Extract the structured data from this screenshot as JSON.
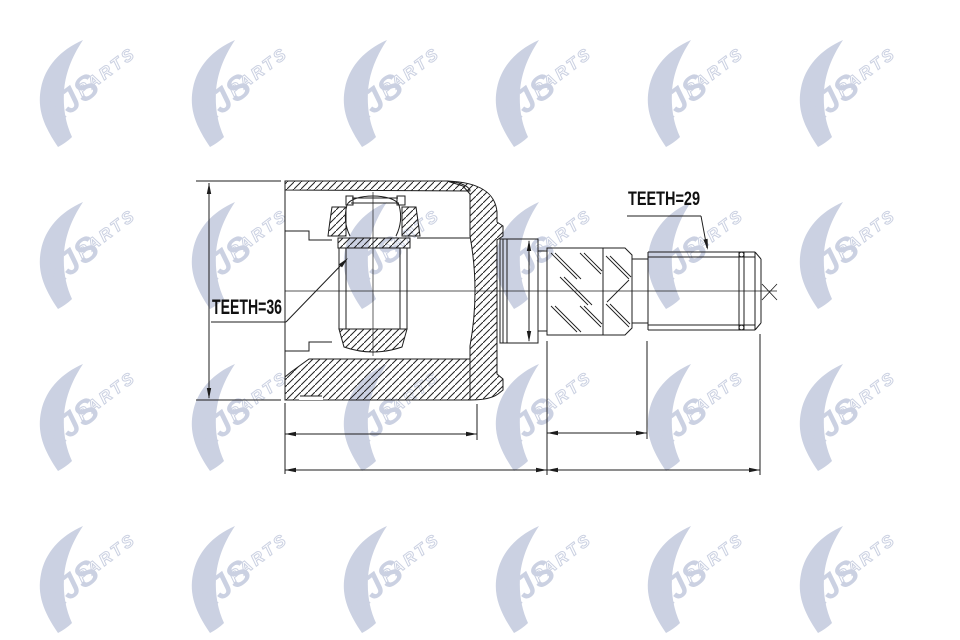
{
  "watermark": {
    "brand": "AJS",
    "suffix": "PARTS",
    "color": "#cbd1e2"
  },
  "drawing": {
    "labels": {
      "teeth_inner": "TEETH=36",
      "teeth_outer": "TEETH=29"
    },
    "line_color": "#1c1c1c"
  }
}
